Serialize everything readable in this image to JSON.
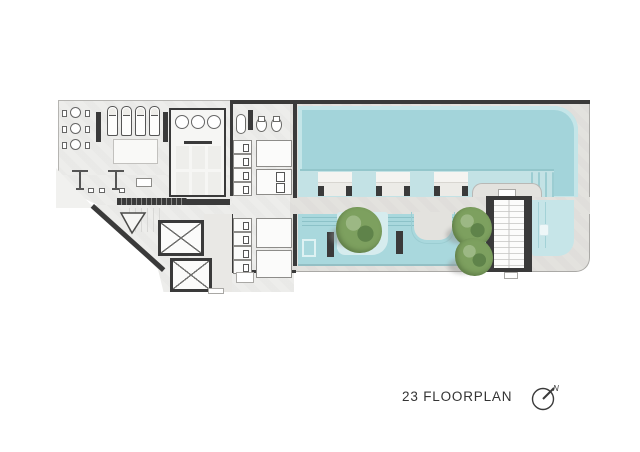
{
  "title": {
    "label": "23 FLOORPLAN"
  },
  "north_arrow": {
    "label": "N"
  },
  "palette": {
    "paper": "#ffffff",
    "indoor-floor": "#ededeb",
    "deck": "#e3e2de",
    "wall-dark": "#3a3a3a",
    "water-main": "#a3d4da",
    "water-shelf": "#c3e2e5",
    "water-lower": "#a9d8dd",
    "water-light": "#c6e5e8",
    "water-line": "#8cc2c8",
    "tree-green": "#7da05f",
    "tree-green-dark": "#5f834a",
    "tree-green-light": "#9cb884",
    "text": "#343434"
  },
  "inventory": {
    "round_tables": 3,
    "indoor_sun_loungers": 4,
    "spa_chairs": 3,
    "spa_mats": 6,
    "toilet_stalls_top": 4,
    "toilet_stalls_bottom": 4,
    "in_pool_loungers": 3,
    "trees": 3,
    "elevator_shafts": 2,
    "pools": 2
  }
}
